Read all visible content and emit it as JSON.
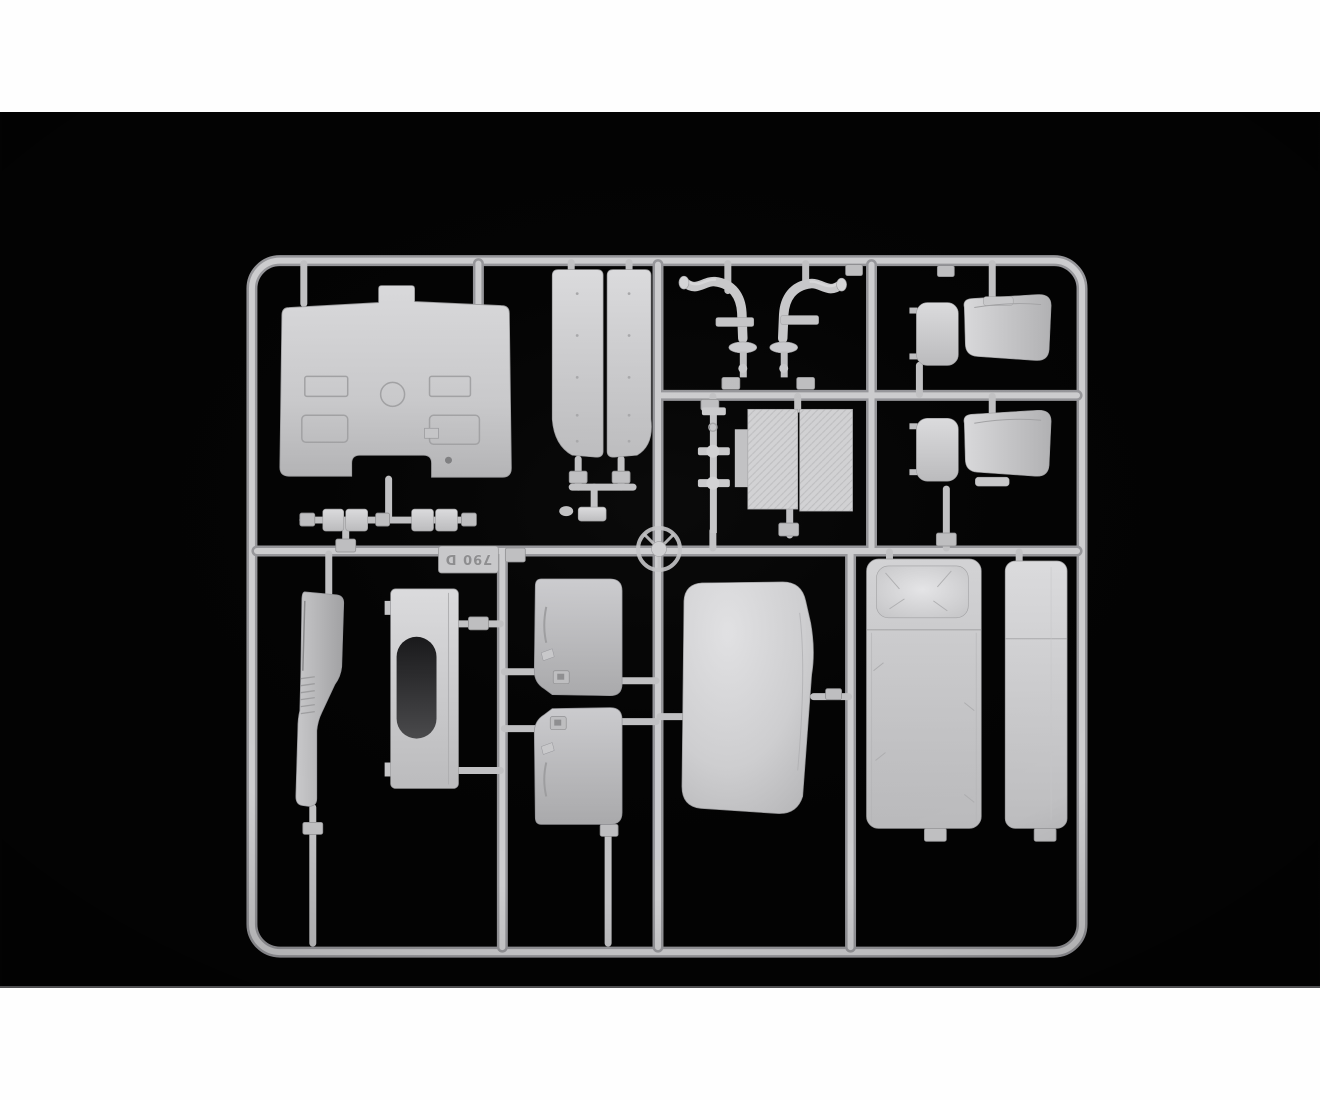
{
  "page": {
    "background_hex": "#fefefe"
  },
  "photo": {
    "background_hex": "#030303",
    "bottom_edge_line_hex": "#4e4e50",
    "subject": "product photo of an injection-molded light grey styrene model-kit sprue (truck cab interior parts) on a black background",
    "mold_tag_text": "790 D",
    "plastic": {
      "base_hex": "#c8c8ca",
      "highlight_hex": "#e2e2e4",
      "shadow_hex": "#96969a",
      "dark_recess_hex": "#2a2a2c"
    },
    "parts": [
      {
        "name": "cab-front-panel",
        "note": "large dashboard/front wall with arch cutout"
      },
      {
        "name": "side-panel-left"
      },
      {
        "name": "side-panel-right"
      },
      {
        "name": "small-fittings-row",
        "note": "four small clip boxes under front panel"
      },
      {
        "name": "exhaust-pipe-left"
      },
      {
        "name": "exhaust-pipe-right"
      },
      {
        "name": "steering-column"
      },
      {
        "name": "tread-plate-left",
        "note": "diamond-plate textured floor plate"
      },
      {
        "name": "tread-plate-right",
        "note": "diamond-plate textured floor plate"
      },
      {
        "name": "seat-upper"
      },
      {
        "name": "seat-lower"
      },
      {
        "name": "steering-wheel"
      },
      {
        "name": "center-console"
      },
      {
        "name": "engine-tunnel-cover",
        "note": "panel with dark oval recess"
      },
      {
        "name": "door-card-upper"
      },
      {
        "name": "door-card-lower"
      },
      {
        "name": "cab-rear-cushion-panel",
        "note": "large rounded pillowy panel"
      },
      {
        "name": "bunk-bed-with-pillow"
      },
      {
        "name": "bunk-side-panel",
        "note": "long narrow panel"
      },
      {
        "name": "mold-number-tag"
      }
    ]
  }
}
